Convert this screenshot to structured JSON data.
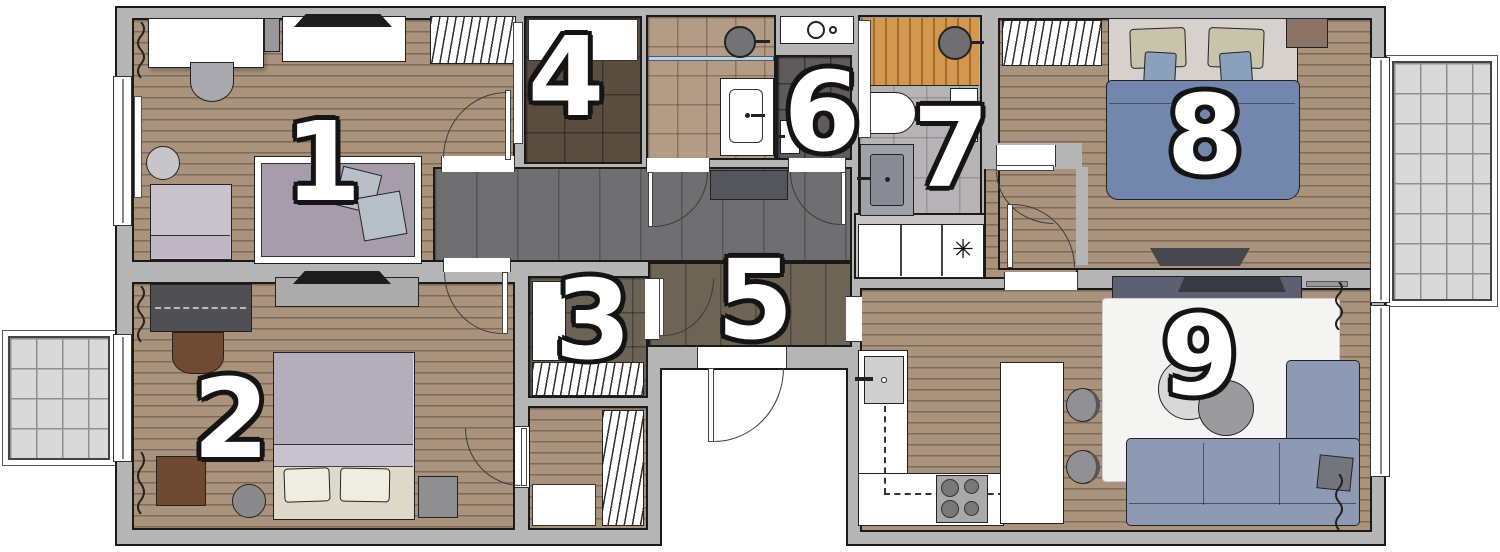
{
  "title": "Apartment floor plan with numbered rooms",
  "rooms": [
    {
      "label": "1",
      "type": "bedroom"
    },
    {
      "label": "2",
      "type": "bedroom"
    },
    {
      "label": "3",
      "type": "walk-in-closet"
    },
    {
      "label": "4",
      "type": "walk-in-closet"
    },
    {
      "label": "5",
      "type": "hallway"
    },
    {
      "label": "6",
      "type": "wc"
    },
    {
      "label": "7",
      "type": "shower-bathroom"
    },
    {
      "label": "8",
      "type": "bedroom"
    },
    {
      "label": "9",
      "type": "living-room-kitchen"
    }
  ],
  "symbols": {
    "appliance": "✳"
  },
  "colors": {
    "line": "#1a1a1a",
    "wall": "#b5b5b6",
    "wood": "#aa937d",
    "wood_line": "#7d6a58",
    "corridor": "#6f6f71",
    "corridor_line": "#565658",
    "hall": "#6e6455",
    "closet_dark": "#5a4d3f",
    "closet_mid": "#6b6355",
    "bath_beige": "#b29c85",
    "bath_dark": "#5f5b5c",
    "bath7_floor": "#b6b2b5",
    "shower_wood": "#d3984f",
    "balcony": "#d9d9d9",
    "balcony_line": "#8f8f8f",
    "duvet_blue": "#7287ab",
    "pillow_beige": "#c7c4ab",
    "pillow_blue": "#8ba0bd",
    "sheet": "#d7d1cd",
    "sofa": "#8e9ab4",
    "rug": "#f4f4f3",
    "duvet_lavender": "#b3adbc",
    "bed_cream": "#ded9cb",
    "tv_black": "#1c1c1c",
    "console": "#5d6070"
  }
}
